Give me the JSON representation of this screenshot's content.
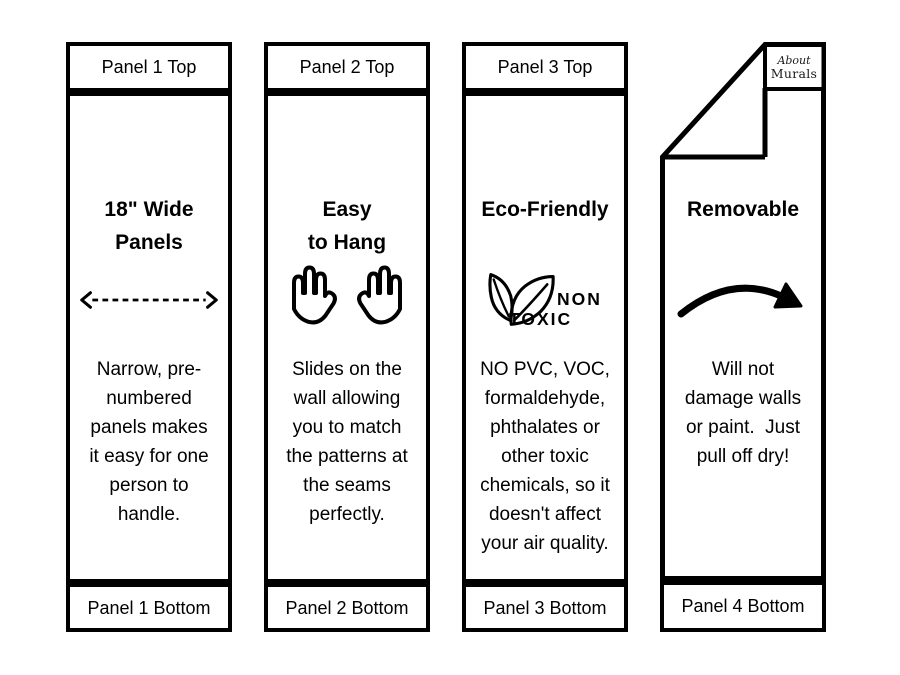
{
  "colors": {
    "ink": "#000000",
    "paper": "#ffffff"
  },
  "panels": [
    {
      "top_label": "Panel 1 Top",
      "title": "18\" Wide\nPanels",
      "icon": "dashed-width-arrow",
      "body": "Narrow, pre-\nnumbered\npanels makes\nit easy for one\nperson to\nhandle.",
      "bottom_label": "Panel 1 Bottom"
    },
    {
      "top_label": "Panel 2 Top",
      "title": "Easy\nto Hang",
      "icon": "two-open-hands",
      "body": "Slides on the\nwall allowing\nyou to match\nthe patterns at\nthe seams\nperfectly.",
      "bottom_label": "Panel 2 Bottom"
    },
    {
      "top_label": "Panel 3 Top",
      "title": "Eco-Friendly",
      "icon": "non-toxic-leaves",
      "icon_label_top": "NON",
      "icon_label_bottom": "TOXIC",
      "body": "NO PVC, VOC,\nformaldehyde,\nphthalates or\nother toxic\nchemicals, so it\ndoesn't affect\nyour air quality.",
      "bottom_label": "Panel 3 Bottom"
    },
    {
      "title": "Removable",
      "icon": "curved-peel-arrow",
      "logo": {
        "line1": "About",
        "line2": "Murals"
      },
      "body": "Will not\ndamage walls\nor paint.  Just\npull off dry!",
      "bottom_label": "Panel 4 Bottom"
    }
  ]
}
